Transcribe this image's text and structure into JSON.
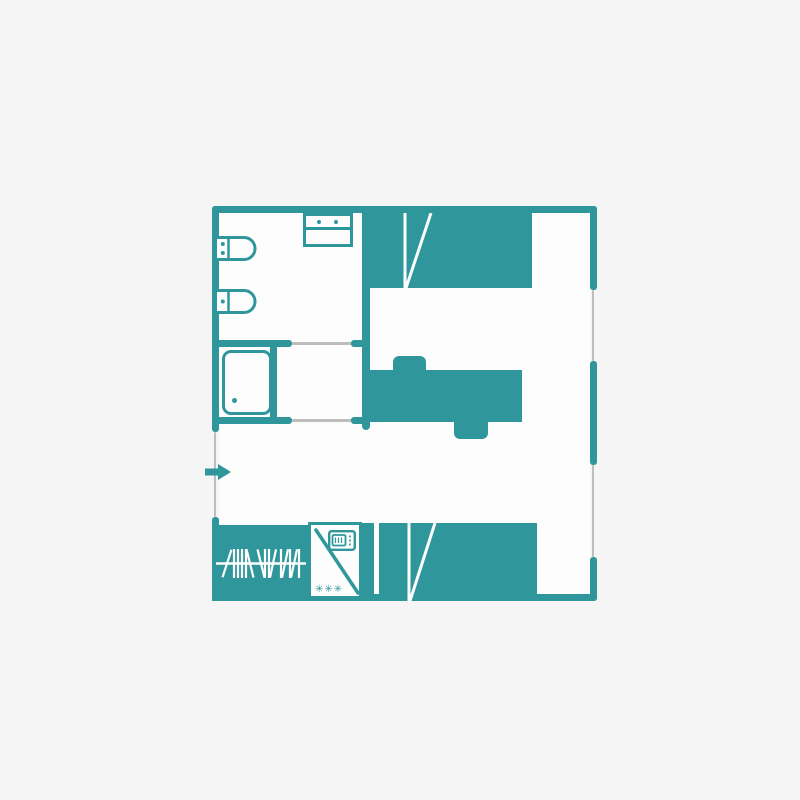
{
  "colors": {
    "accent": "#2F969B",
    "background": "#F5F5F5",
    "floor": "#FDFDFD",
    "opening": "#BDBDBD"
  },
  "floor_plan": {
    "name": "mobile-home-floor-plan",
    "kitchenette": {
      "freezer_rating": "✳✳✳"
    },
    "fixtures": [
      {
        "name": "washbasin",
        "icon": "washbasin-icon"
      },
      {
        "name": "toilet",
        "icon": "toilet-icon"
      },
      {
        "name": "vanity-sink",
        "icon": "sink-icon"
      },
      {
        "name": "shower",
        "icon": "shower-tray-icon"
      },
      {
        "name": "bunk-bed-top",
        "icon": "bunk-bed-icon"
      },
      {
        "name": "double-bed",
        "icon": "double-bed-icon"
      },
      {
        "name": "wardrobe",
        "icon": "clothes-hangers-icon"
      },
      {
        "name": "kitchenette",
        "icon": "fridge-microwave-icon"
      },
      {
        "name": "bunk-bed-bottom",
        "icon": "bunk-bed-icon"
      },
      {
        "name": "entrance",
        "icon": "entrance-arrow-icon"
      }
    ]
  }
}
